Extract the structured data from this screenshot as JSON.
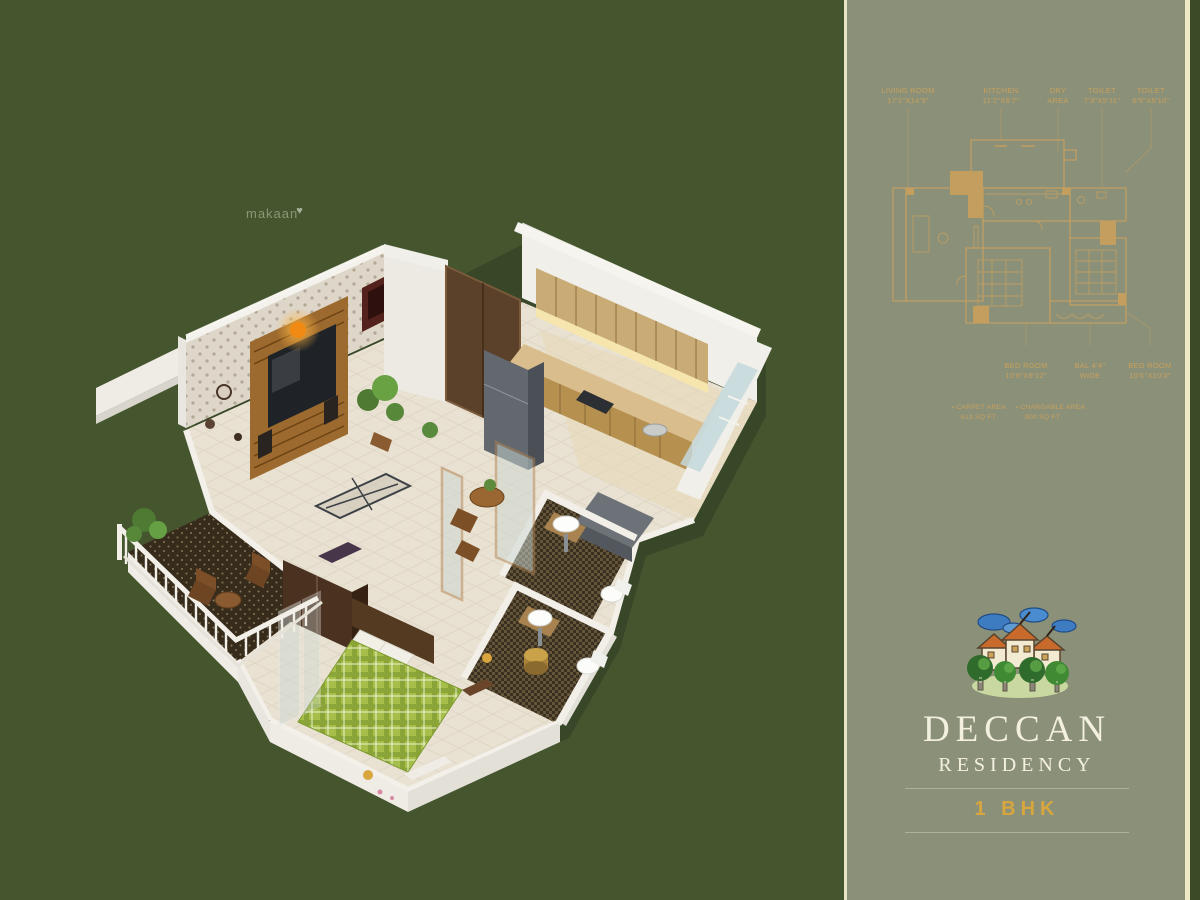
{
  "watermark": {
    "text": "makaan",
    "heart": "♥"
  },
  "colors": {
    "background": "#45562f",
    "panel": "#8b9179",
    "accent_gold": "#c89f5e",
    "brand_white": "#f4f0e0",
    "bhk_gold": "#d7a63e",
    "divider_cream": "#e9e4c4",
    "cloud_blue": "#3e7cc1",
    "roof_orange": "#c96a2d",
    "tree_green": "#3f8a33"
  },
  "panel": {
    "bullet": "▪",
    "top_labels": [
      {
        "line1": "LIVING ROOM",
        "line2": "17'2\"X14'9\""
      },
      {
        "line1": "KITCHEN",
        "line2": "11'2\"X6'7\""
      },
      {
        "line1": "DRY",
        "line2": "AREA"
      },
      {
        "line1": "TOILET",
        "line2": "7'3\"X5'11\""
      },
      {
        "line1": "TOILET",
        "line2": "6'5\"X5'10\""
      }
    ],
    "bottom_labels": [
      {
        "line1": "BED ROOM",
        "line2": "10'6\"X9'12\""
      },
      {
        "line1": "BAL 4'4\"",
        "line2": "WIDE"
      },
      {
        "line1": "BED ROOM",
        "line2": "10'6\"X10'3\""
      }
    ],
    "area_notes": [
      {
        "line1": "CARPET AREA",
        "line2": "613 SQ FT"
      },
      {
        "line1": "CHARGABLE AREA",
        "line2": "900 SQ FT"
      }
    ]
  },
  "brand": {
    "title": "DECCAN",
    "subtitle": "RESIDENCY",
    "type": "1 BHK"
  }
}
